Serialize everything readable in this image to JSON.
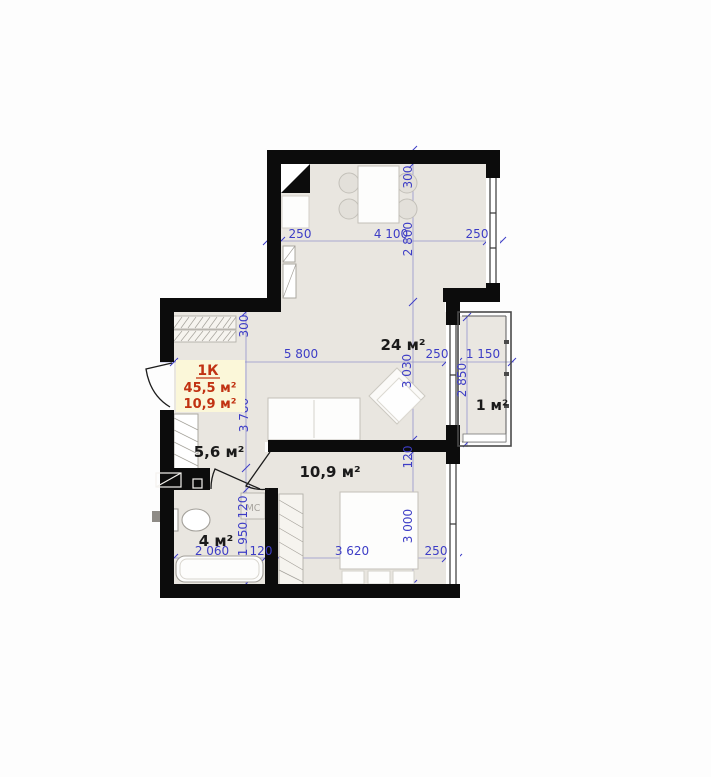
{
  "plan": {
    "info_box": {
      "type_label": "1К",
      "area_total": "45,5 м²",
      "area_living": "10,9 м²"
    },
    "room_labels": {
      "kitchen_living": "24 м²",
      "hallway": "5,6 м²",
      "bedroom": "10,9 м²",
      "bathroom": "4 м²",
      "balcony": "1 м²",
      "washing_machine": "МС"
    },
    "dimensions": {
      "kitchen": {
        "left_wall": "250",
        "width": "4 100",
        "right_wall": "250",
        "top_wall": "300",
        "depth": "2 800"
      },
      "living": {
        "width": "5 800",
        "right_wall": "250",
        "depth": "3 030"
      },
      "hallway": {
        "top_wall": "300",
        "depth": "3 780"
      },
      "balcony": {
        "width": "1 150",
        "depth": "2 850"
      },
      "bedroom": {
        "top_wall": "120",
        "width": "3 620",
        "right_wall": "250",
        "depth": "3 000"
      },
      "bathroom": {
        "width": "2 060",
        "right_wall": "120",
        "depth": "1 950",
        "top_wall": "120"
      }
    },
    "colors": {
      "wall": "#0c0c0c",
      "floor": "#e9e6e0",
      "dimension_text": "#3d3dc6",
      "room_text": "#1a1a1a",
      "info_text": "#c13212",
      "info_bg": "#fbf7d9"
    }
  }
}
